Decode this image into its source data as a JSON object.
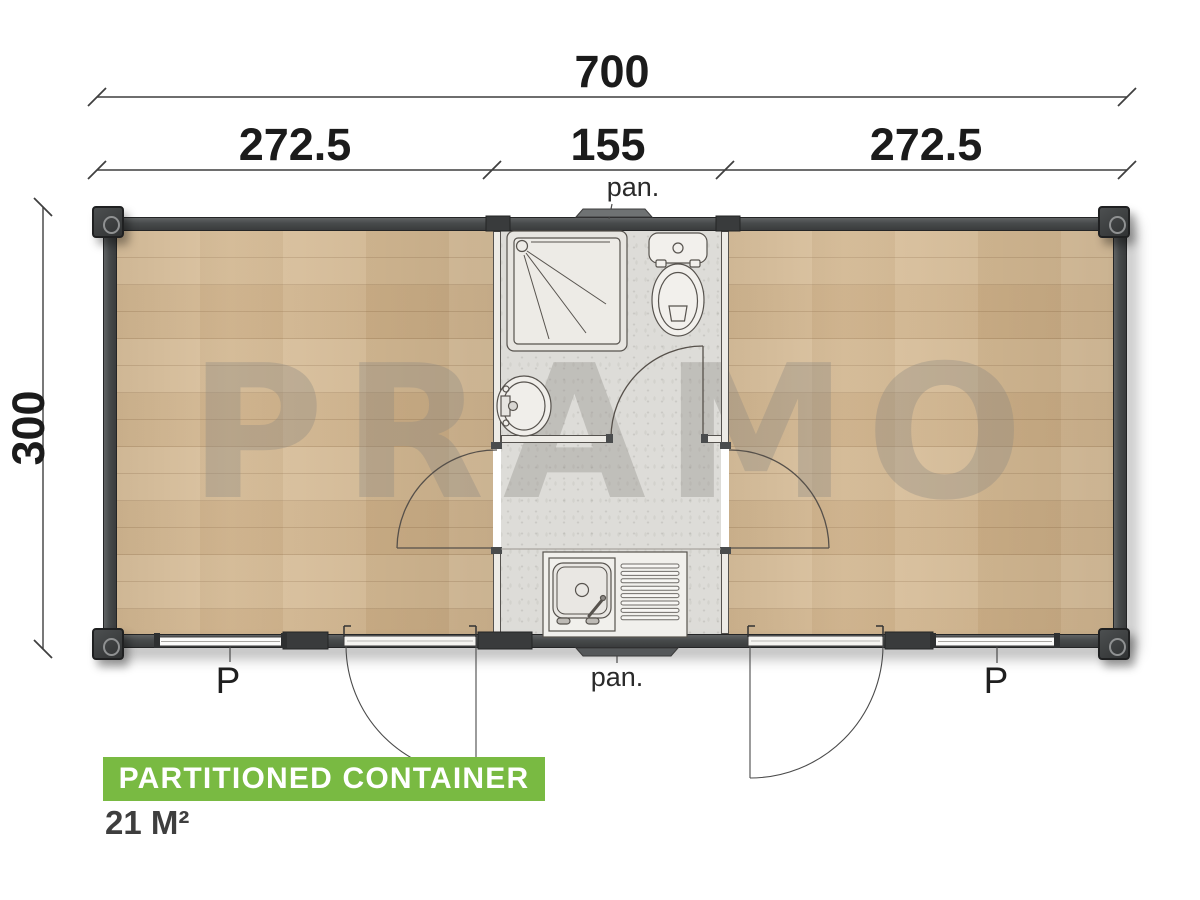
{
  "watermark": {
    "text": "PRAMO"
  },
  "dimensions": {
    "total_width": "700",
    "segments": [
      {
        "label": "272.5"
      },
      {
        "label": "155"
      },
      {
        "label": "272.5"
      }
    ],
    "depth": "300"
  },
  "labels": {
    "panel_top": "pan.",
    "panel_bottom": "pan.",
    "window_left": "P",
    "window_right": "P"
  },
  "footer": {
    "title": "PARTITIONED CONTAINER",
    "area": "21 M²"
  },
  "colors": {
    "accent_green": "#79ba42",
    "wall_dark": "#46494a",
    "wood_floor": "#d6ba92",
    "core_floor": "#dddcd8",
    "watermark_gray": "#8a8783",
    "dimension_text": "#1b1b1b"
  },
  "fixtures": [
    "shower",
    "toilet",
    "washbasin",
    "kitchen-sink",
    "entry-door-left",
    "entry-door-right",
    "window-left",
    "window-right"
  ]
}
